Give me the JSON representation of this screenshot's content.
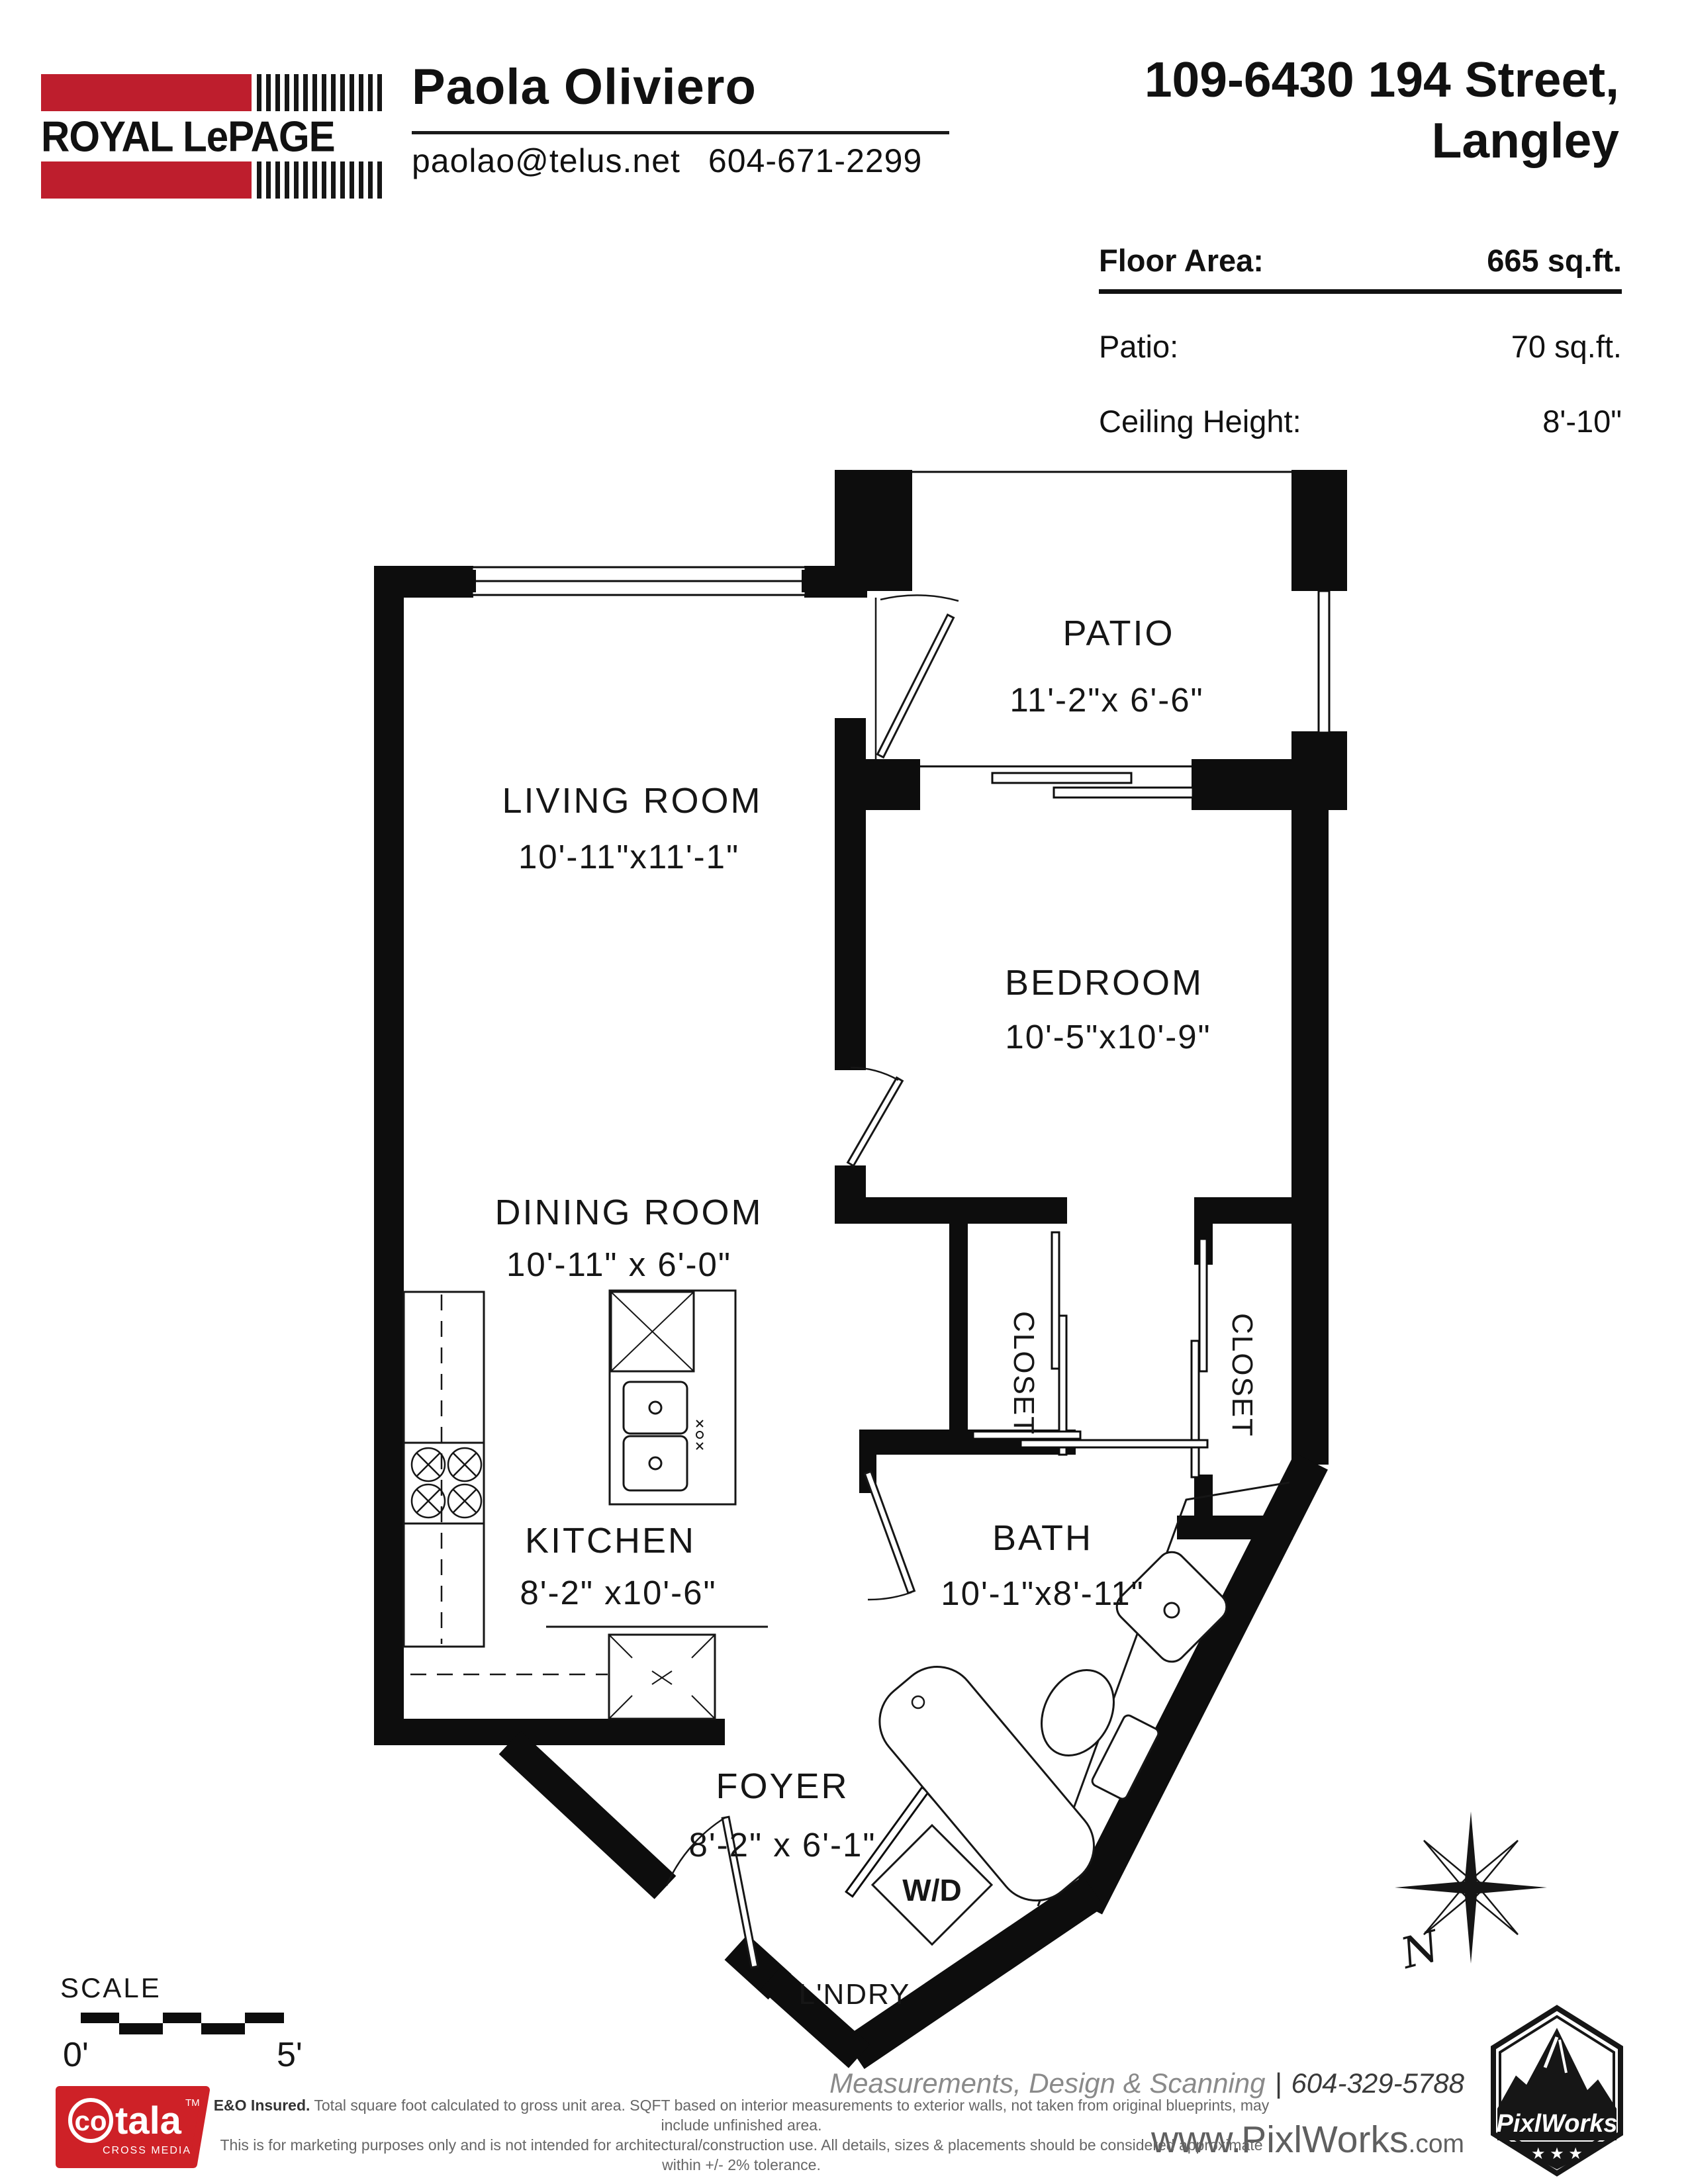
{
  "header": {
    "brand": {
      "name": "ROYAL LePAGE",
      "accent_color": "#BE1E2D"
    },
    "agent": {
      "name": "Paola Oliviero",
      "email": "paolao@telus.net",
      "phone": "604-671-2299"
    },
    "address_line1": "109-6430 194 Street,",
    "address_line2": "Langley"
  },
  "info": {
    "rows": [
      {
        "label": "Floor Area:",
        "value": "665 sq.ft."
      },
      {
        "label": "Patio:",
        "value": "70 sq.ft."
      },
      {
        "label": "Ceiling Height:",
        "value": "8'-10\""
      }
    ]
  },
  "floorplan": {
    "rooms": [
      {
        "name": "PATIO",
        "dims": "11'-2\"x  6'-6\""
      },
      {
        "name": "LIVING ROOM",
        "dims": "10'-11\"x11'-1\""
      },
      {
        "name": "DINING ROOM",
        "dims": "10'-11\" x  6'-0\""
      },
      {
        "name": "BEDROOM",
        "dims": "10'-5\"x10'-9\""
      },
      {
        "name": "KITCHEN",
        "dims": "8'-2\" x10'-6\""
      },
      {
        "name": "BATH",
        "dims": "10'-1\"x8'-11\""
      },
      {
        "name": "FOYER",
        "dims": "8'-2\" x  6'-1\""
      }
    ],
    "labels": {
      "closet": "CLOSET",
      "wd": "W/D",
      "laundry": "L'NDRY",
      "compass_north": "N"
    }
  },
  "scale": {
    "title": "SCALE",
    "start": "0'",
    "end": "5'"
  },
  "footer": {
    "cotala": {
      "word1": "co",
      "word2": "tala",
      "tm": "TM",
      "subtitle": "CROSS MEDIA",
      "color": "#CE2127"
    },
    "services": "Measurements, Design & Scanning",
    "separator": "|",
    "phone": "604-329-5788",
    "website_main": "www.PixlWorks",
    "website_tld": ".com",
    "disclaimer1_bold": "E&O Insured.",
    "disclaimer1": "Total square foot calculated to gross unit area. SQFT based on interior measurements to exterior walls, not taken from original blueprints, may include unfinished area.",
    "disclaimer2": "This is for marketing purposes only and is not intended for architectural/construction use.  All details, sizes & placements should be considered approximate within +/- 2%  tolerance.",
    "pixlworks": {
      "name": "PixlWorks",
      "stars": "★ ★ ★"
    }
  }
}
